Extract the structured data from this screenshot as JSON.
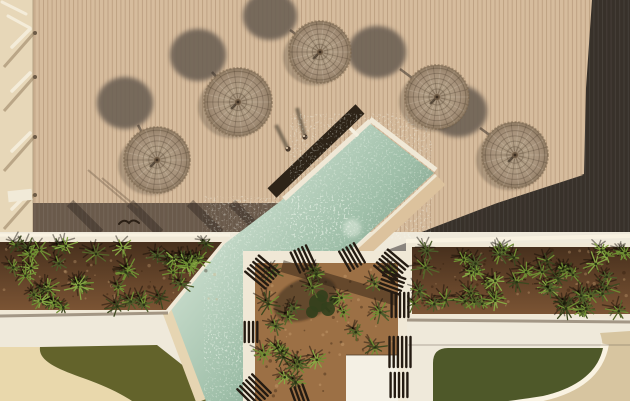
{
  "scene": {
    "name": "aerial-pool-deck-photo",
    "canvas": {
      "w": 630,
      "h": 401
    },
    "palette": {
      "deck": "#d6bc9d",
      "deck_line": "rgba(140,104,74,0.35)",
      "deck_dark": "#38312a",
      "deck_dark_line": "rgba(255,255,255,0.07)",
      "band": "#6a5a4b",
      "band_streak": "rgba(40,32,26,0.38)",
      "strip": "#e7d7b8",
      "path": "#efe9da",
      "coping": "#f0e8d6",
      "coping_bright": "#f9f2e1",
      "tan_coping": "#dcc29d",
      "gray_path": "#8a847e",
      "water_light": "#c4d9c8",
      "water_mid": "#9fbfa9",
      "water_deep": "#7e9d88",
      "soil": "#7b5434",
      "soil_center": "#9c7045",
      "grass_left": "#63632b",
      "grass_right": "#4e5829",
      "sand": "#e9d8ac",
      "tan_corner": "#d7c5a0",
      "umb_base": "#b19e85",
      "umb_mid": "#a6917a",
      "umb_dark": "#8f7b63",
      "umb_ring": "rgba(70,55,40,0.3)",
      "umb_spoke_dark": "rgba(60,45,30,0.25)",
      "umb_spoke_light": "rgba(250,240,220,0.18)",
      "shadow_disc": "#6b5e52",
      "slat": "#241b12",
      "shadow_line": "rgba(70,50,30,0.45)",
      "plant_shadow": "rgba(15,10,5,0.45)",
      "plant_colors": [
        "#3c481f",
        "#55662a",
        "#6f8f33",
        "#87a844",
        "#4c5d2a"
      ]
    },
    "deck": {
      "rect": [
        0,
        0,
        630,
        246
      ],
      "plank_spacing": 4.3
    },
    "left_strip": {
      "rect": [
        0,
        0,
        33,
        246
      ],
      "posts_y": [
        33,
        77,
        137,
        195
      ],
      "table_rect": [
        8,
        190,
        24,
        11
      ],
      "top_bars": [
        [
          2,
          2,
          26,
          14
        ],
        [
          8,
          16,
          30,
          28
        ]
      ]
    },
    "dark_right_poly": [
      [
        592,
        0
      ],
      [
        630,
        0
      ],
      [
        630,
        238
      ],
      [
        406,
        238
      ],
      [
        497,
        203
      ],
      [
        584,
        174
      ],
      [
        586,
        88
      ]
    ],
    "band_left_poly": [
      [
        33,
        203
      ],
      [
        279,
        203
      ],
      [
        242,
        233
      ],
      [
        33,
        233
      ]
    ],
    "band_streaks": [
      [
        70,
        203,
        100,
        233
      ],
      [
        130,
        203,
        160,
        233
      ],
      [
        190,
        203,
        220,
        233
      ],
      [
        232,
        203,
        258,
        229
      ]
    ],
    "deck_wedge_poly": [
      [
        437,
        176
      ],
      [
        583,
        175
      ],
      [
        497,
        203
      ],
      [
        407,
        236
      ],
      [
        357,
        252
      ]
    ],
    "white_base_rect": [
      0,
      232,
      630,
      169
    ],
    "pool": {
      "water_poly": [
        [
          368,
          122
        ],
        [
          434,
          173
        ],
        [
          348,
          252
        ],
        [
          248,
          258
        ],
        [
          248,
          401
        ],
        [
          206,
          401
        ],
        [
          164,
          290
        ],
        [
          282,
          200
        ]
      ],
      "nw_dark_line": [
        360,
        109,
        272,
        193
      ],
      "nw_white_line": [
        370,
        121,
        284,
        199
      ],
      "ne_white_line": [
        370,
        119,
        436,
        170
      ],
      "se_tan_line": [
        441,
        180,
        352,
        262
      ],
      "se_white_line": [
        436,
        175,
        349,
        255
      ],
      "w_coping_line": [
        160,
        292,
        201,
        401
      ],
      "sparkle_zones": [
        [
          [
            368,
            124
          ],
          [
            420,
            162
          ],
          [
            350,
            228
          ],
          [
            302,
            190
          ]
        ],
        [
          [
            280,
            210
          ],
          [
            340,
            254
          ],
          [
            262,
            348
          ],
          [
            216,
            310
          ]
        ],
        [
          [
            212,
            358
          ],
          [
            248,
            338
          ],
          [
            248,
            401
          ],
          [
            208,
            401
          ]
        ]
      ],
      "splash": [
        352,
        228,
        9
      ],
      "ladder": [
        350,
        128,
        358,
        136
      ]
    },
    "planters": {
      "left": {
        "poly": [
          [
            0,
            237
          ],
          [
            230,
            237
          ],
          [
            168,
            314
          ],
          [
            0,
            314
          ]
        ],
        "top_hl": [
          0,
          235,
          230,
          235
        ],
        "bottom_shadow": [
          0,
          316,
          168,
          313
        ],
        "scatter": {
          "n": 42,
          "x0": 4,
          "x1": 226,
          "y0": 244,
          "y1": 308,
          "diag": [
            230,
            238,
            0.82,
            8
          ]
        }
      },
      "right": {
        "rect": [
          406,
          243,
          224,
          75
        ],
        "top_hl": [
          406,
          241,
          630,
          236
        ],
        "bottom_shadow": [
          406,
          320,
          630,
          322
        ],
        "scatter": {
          "n": 48,
          "x0": 412,
          "x1": 626,
          "y0": 248,
          "y1": 312
        }
      },
      "center": {
        "outer_rect": [
          243,
          251,
          164,
          150
        ],
        "soil_rect": [
          255,
          263,
          143,
          138
        ],
        "sunbed_rect": [
          346,
          355,
          52,
          46
        ],
        "diag_shadow": [
          282,
          266,
          397,
          300
        ],
        "scatter": {
          "n": 24,
          "x0": 261,
          "x1": 394,
          "y0": 268,
          "y1": 396,
          "avoid": [
            342,
            350,
            407,
            401
          ]
        }
      }
    },
    "gray_strip_poly": [
      [
        366,
        258
      ],
      [
        406,
        243
      ],
      [
        406,
        348
      ],
      [
        382,
        348
      ]
    ],
    "slats": [
      [
        262,
        272,
        40,
        6,
        26
      ],
      [
        303,
        259,
        65,
        5,
        22
      ],
      [
        352,
        257,
        60,
        5,
        22
      ],
      [
        391,
        266,
        40,
        6,
        26
      ],
      [
        400,
        305,
        90,
        5,
        24
      ],
      [
        400,
        352,
        90,
        6,
        30
      ],
      [
        399,
        385,
        90,
        5,
        24
      ],
      [
        251,
        332,
        90,
        4,
        20
      ],
      [
        254,
        391,
        45,
        6,
        26
      ],
      [
        300,
        396,
        70,
        4,
        20
      ],
      [
        392,
        283,
        20,
        5,
        22
      ]
    ],
    "tree": {
      "shadow": [
        305,
        299,
        33,
        20,
        -24
      ],
      "crown": [
        [
          318,
          303,
          9
        ],
        [
          328,
          309,
          7
        ],
        [
          322,
          296,
          6
        ],
        [
          334,
          300,
          5
        ],
        [
          312,
          312,
          6
        ]
      ],
      "trunk": [
        330,
        312,
        322,
        304
      ]
    },
    "grass_left_path": "M 40,347 L 157,345 L 228,401 L 132,401 C 118,392 103,385 80,377 C 55,368 38,360 40,347 Z",
    "sand_path": "M 0,347 L 40,347 C 38,360 55,368 80,377 C 103,385 118,392 132,401 L 0,401 Z",
    "grass_right_path": "M 433,363 Q 433,348 448,348 L 603,348 C 598,372 577,388 543,396 C 530,398 516,400 508,401 L 433,401 Z",
    "tan_corner_path": "M 600,333 L 630,331 L 630,401 L 508,401 C 545,395 585,383 603,348 Q 602,338 600,333 Z",
    "curve_white_path": "M 605,344 C 600,372 578,389 543,397 C 530,400 516,401 508,402",
    "path_seam": [
      408,
      345,
      630,
      345
    ],
    "umbrellas": [
      {
        "cx": 157,
        "cy": 160,
        "r": 33
      },
      {
        "cx": 238,
        "cy": 102,
        "r": 34
      },
      {
        "cx": 320,
        "cy": 52,
        "r": 31
      },
      {
        "cx": 437,
        "cy": 97,
        "r": 32
      },
      {
        "cx": 515,
        "cy": 155,
        "r": 33
      }
    ],
    "umbrella_shadows": [
      {
        "cx": 125,
        "cy": 103,
        "rx": 28,
        "ry": 26
      },
      {
        "cx": 198,
        "cy": 55,
        "rx": 28,
        "ry": 26
      },
      {
        "cx": 270,
        "cy": 16,
        "rx": 27,
        "ry": 24
      },
      {
        "cx": 377,
        "cy": 52,
        "rx": 29,
        "ry": 26
      },
      {
        "cx": 458,
        "cy": 111,
        "rx": 29,
        "ry": 26
      }
    ],
    "pole_shadows": [
      [
        138,
        125,
        155,
        157
      ],
      [
        212,
        72,
        236,
        99
      ],
      [
        290,
        30,
        318,
        50
      ],
      [
        400,
        69,
        435,
        95
      ],
      [
        480,
        128,
        513,
        152
      ]
    ],
    "person_shadows": [
      [
        297,
        108,
        305,
        137
      ],
      [
        276,
        125,
        288,
        149
      ]
    ],
    "person_dots": [
      [
        305,
        137
      ],
      [
        288,
        149
      ]
    ],
    "bird_path": "M 119,224 q 5,-6 10,-1 q 4,-5 10,0",
    "deck_thin_shadows": [
      [
        88,
        170,
        128,
        204
      ],
      [
        102,
        178,
        138,
        208
      ]
    ]
  }
}
